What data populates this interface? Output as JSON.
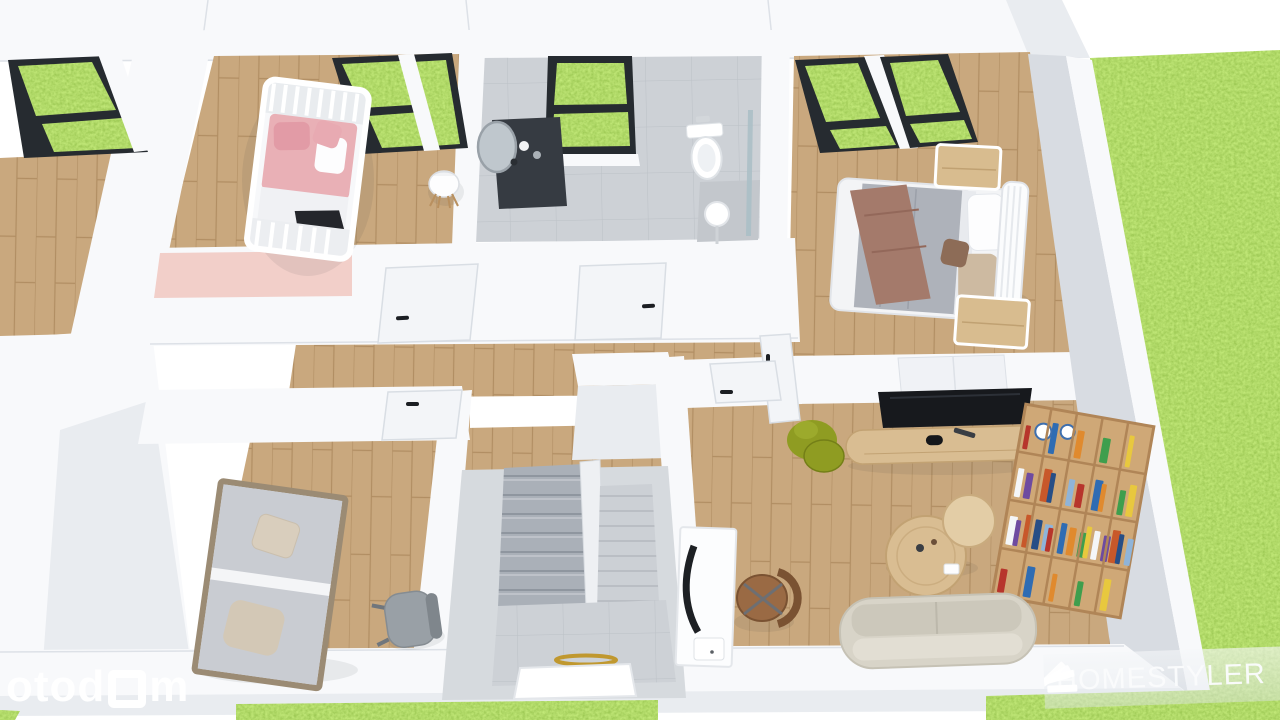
{
  "branding": {
    "otodom": {
      "prefix": "otod",
      "suffix": "m",
      "full": "otodom"
    },
    "homestyler": {
      "label": "HOMESTYLER",
      "icon": "fan-stack-icon"
    }
  },
  "colors": {
    "bg": "#ffffff",
    "wall": "#f8f9fb",
    "wall-shade": "#e9ecf0",
    "wall-dark": "#d8dce2",
    "wall-deep": "#c8cdd5",
    "line": "#dde1e7",
    "grass": "#72b32a",
    "grass-dark": "#619e23",
    "wood": "#c9a87e",
    "wood-dark": "#b18e63",
    "tile": "#cdd1d6",
    "tile-line": "#bcc1c7",
    "tile-dark": "#c3c7cc",
    "pink": "#f2cfc9",
    "crib-pink": "#e9b0b6",
    "frame": "#262b30",
    "tv": "#17191d",
    "sofa": "#d8d4c8",
    "sofa-dark": "#c6c2b5",
    "shelf": "#cfa877",
    "shelf-dark": "#b08557",
    "stair": "#aab0b8",
    "stair-line": "#8f969f",
    "stair2": "#ccd0d5",
    "rail": "#969ea7",
    "gold": "#c0982f",
    "olive": "#8f9c22",
    "olive-dark": "#747f17",
    "chair-brown": "#9a6a44",
    "chair-brown-dark": "#7a5232",
    "chair-gray": "#99a0a6",
    "bed-gray": "#aeb2ba",
    "blanket": "#c9ccd2",
    "throw": "#a47a6b",
    "tan": "#cdbaa1",
    "mirror": "#bfc7cd",
    "watermark": "#ffffff"
  },
  "bookshelf": {
    "spine_colors": [
      "#b7352c",
      "#2f6cb3",
      "#e08a2e",
      "#3f9e4d",
      "#e8c83e",
      "#f4f6f8",
      "#6e4ba0",
      "#c8582a",
      "#274e86",
      "#8fb4d9"
    ]
  }
}
